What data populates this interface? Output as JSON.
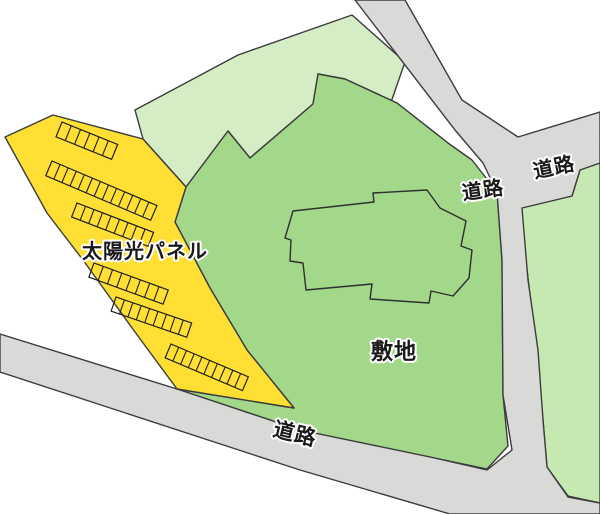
{
  "map": {
    "width": 600,
    "height": 514,
    "colors": {
      "background": "#ffffff",
      "outline": "#3c3c3c",
      "road_fill": "#d9d9d8",
      "light_green": "#d5edc4",
      "site_green": "#a3d78a",
      "parcel_green": "#c6e8b1",
      "panel_yellow": "#ffdf33",
      "panel_line": "#1f1f1f",
      "building_line": "#2f2f2f",
      "label_text": "#1a1a1a",
      "label_halo": "#ffffff"
    },
    "labels": {
      "solar_panel": {
        "text": "太陽光パネル",
        "x": 145,
        "y": 258,
        "size": 20,
        "rotate": 0
      },
      "site": {
        "text": "敷地",
        "x": 394,
        "y": 359,
        "size": 22,
        "rotate": 0
      },
      "road_bottom": {
        "text": "道路",
        "x": 295,
        "y": 441,
        "size": 21,
        "rotate": 14
      },
      "road_junction": {
        "text": "道路",
        "x": 483,
        "y": 197,
        "size": 20,
        "rotate": -8
      },
      "road_right": {
        "text": "道路",
        "x": 554,
        "y": 174,
        "size": 20,
        "rotate": -12
      }
    },
    "shapes": [
      {
        "name": "upper-parcel-area",
        "fill": "light_green",
        "points": "135,110 238,55 352,15 405,62 390,105 425,140 458,153 448,143 397,103 345,79 318,74 313,104 250,158 228,131 186,187 143,139"
      },
      {
        "name": "site-area",
        "fill": "site_green",
        "points": "186,187 228,131 250,158 313,104 318,74 345,79 397,103 448,143 472,160 497,192 502,260 503,395 508,446 487,469 430,457 300,430 177,389 294,408 247,350 210,288 175,222"
      },
      {
        "name": "right-parcel-area",
        "fill": "parcel_green",
        "points": "521,208 572,196 580,170 600,162 600,503 568,496 547,467 543,420 536,345 527,270"
      },
      {
        "name": "road-network",
        "fill": "road_fill",
        "points": "355,0 405,0 462,100 518,137 600,112 600,163 580,170 572,196 522,208 528,280 538,350 543,420 547,467 568,497 600,503 600,514 450,514 300,470 0,372 0,334 177,389 300,430 430,457 487,470 512,450 503,395 502,260 497,192 483,163 455,130"
      },
      {
        "name": "solar-panel-area",
        "fill": "panel_yellow",
        "points": "5,137 53,115 143,139 186,187 175,222 210,288 247,350 294,408 177,389 135,332 83,260 47,213"
      }
    ],
    "building": {
      "name": "building-outline",
      "path": "M 293 211 L 374 202 L 373 193 L 427 190 L 440 208 L 466 221 L 461 246 L 472 250 L 469 278 L 453 296 L 431 291 L 429 303 L 370 299 L 372 284 L 306 290 L 303 263 L 290 261 L 291 240 L 285 238 Z"
    },
    "panel_rows": [
      {
        "x": 62,
        "y": 122,
        "len": 60,
        "h": 16,
        "cells": 6,
        "angle": 22
      },
      {
        "x": 52,
        "y": 161,
        "len": 114,
        "h": 16,
        "cells": 13,
        "angle": 23
      },
      {
        "x": 77,
        "y": 203,
        "len": 82,
        "h": 15,
        "cells": 9,
        "angle": 21
      },
      {
        "x": 94,
        "y": 263,
        "len": 79,
        "h": 15,
        "cells": 8,
        "angle": 20
      },
      {
        "x": 116,
        "y": 297,
        "len": 80,
        "h": 15,
        "cells": 9,
        "angle": 19
      },
      {
        "x": 171,
        "y": 344,
        "len": 84,
        "h": 15,
        "cells": 10,
        "angle": 23
      }
    ]
  }
}
